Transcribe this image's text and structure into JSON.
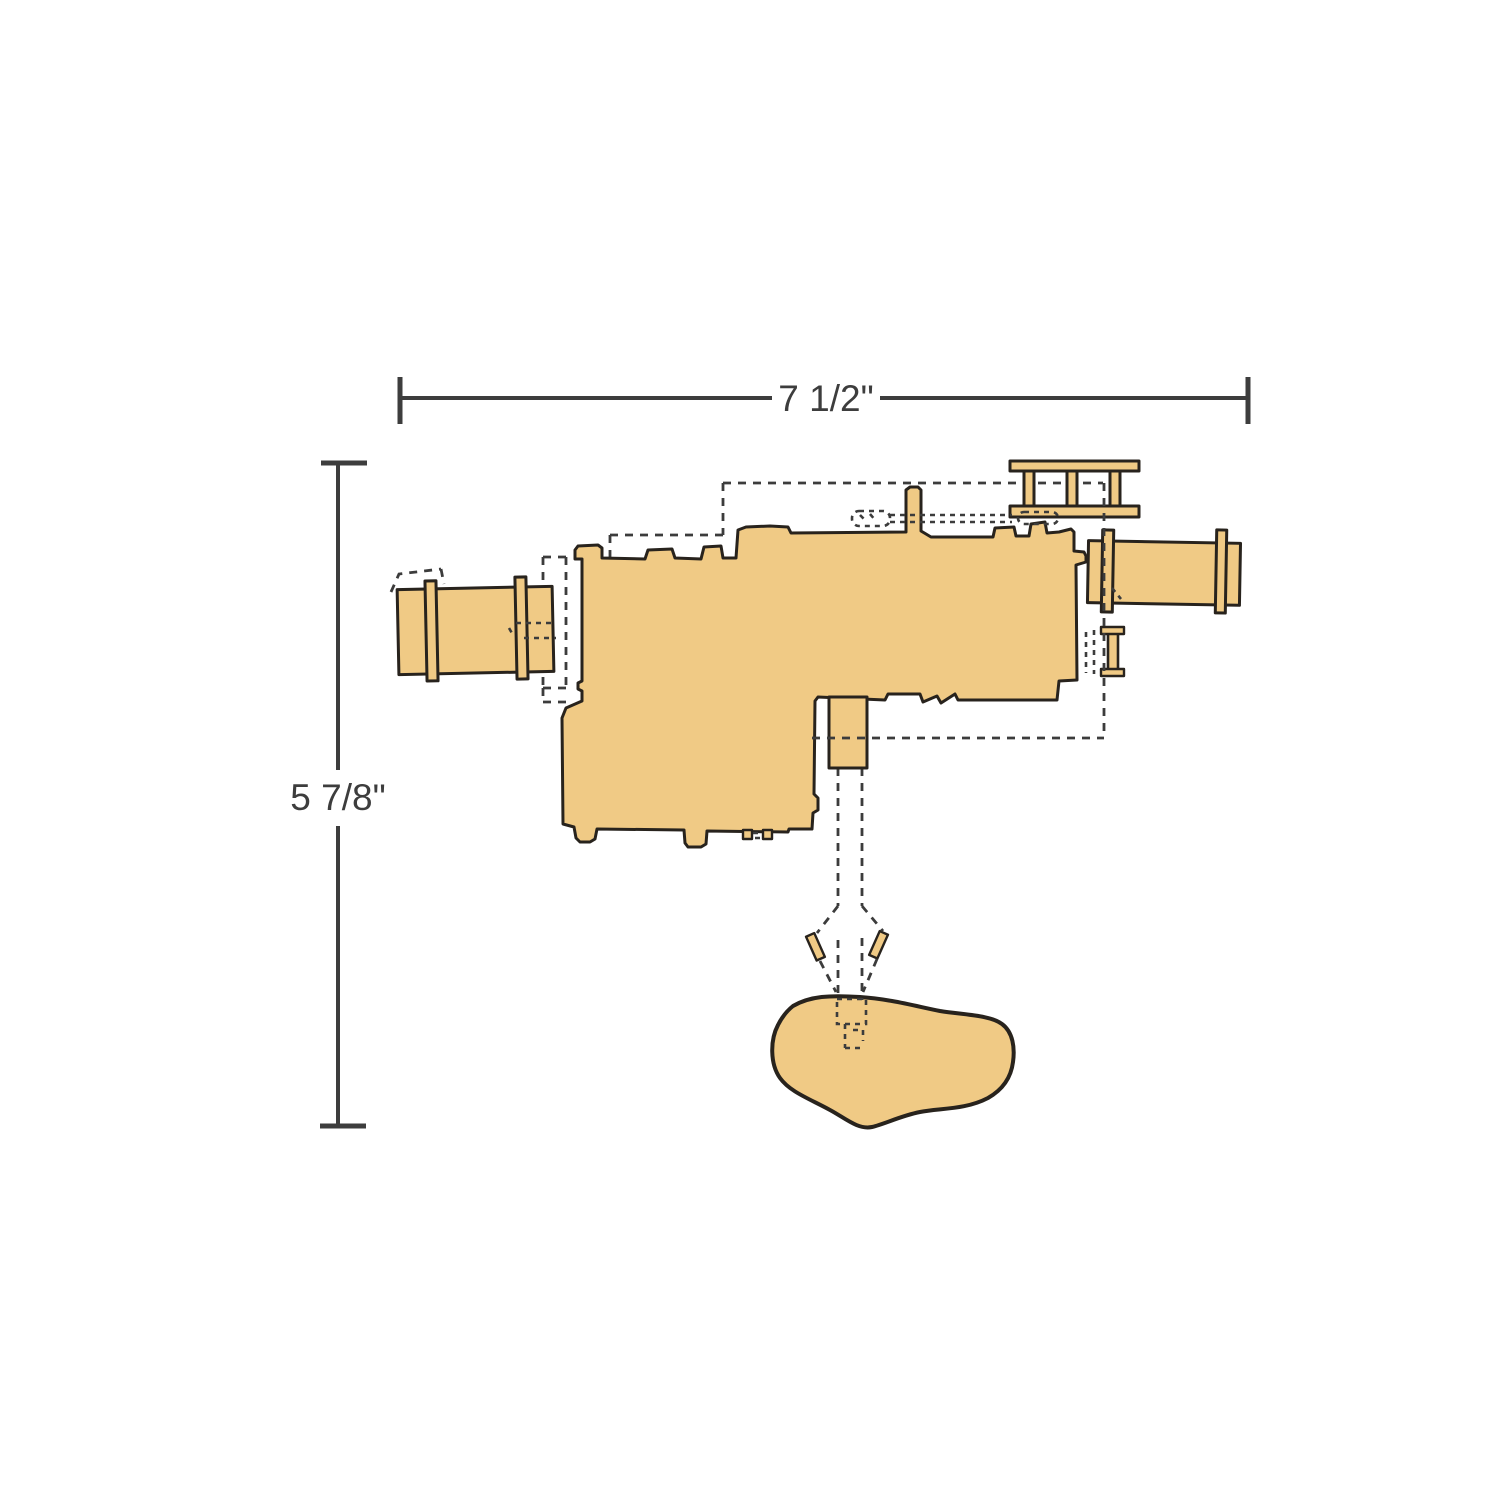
{
  "diagram": {
    "type": "playset-plan-view-dimension-drawing",
    "background": "#ffffff",
    "colors": {
      "fill": "#f0ca85",
      "outline": "#28231d",
      "dashed": "#3c3c3c",
      "dimension": "#3d3d3d"
    },
    "dimensions": {
      "width_label": "7 1/2\"",
      "height_label": "5 7/8\""
    },
    "parts": [
      "main-deck-platform",
      "left-crawl-tube",
      "right-crawl-tube",
      "overhead-ladder",
      "climbing-post",
      "slide-section",
      "swing-drop-path",
      "ground-rock",
      "footprint-dashed-outline"
    ]
  }
}
